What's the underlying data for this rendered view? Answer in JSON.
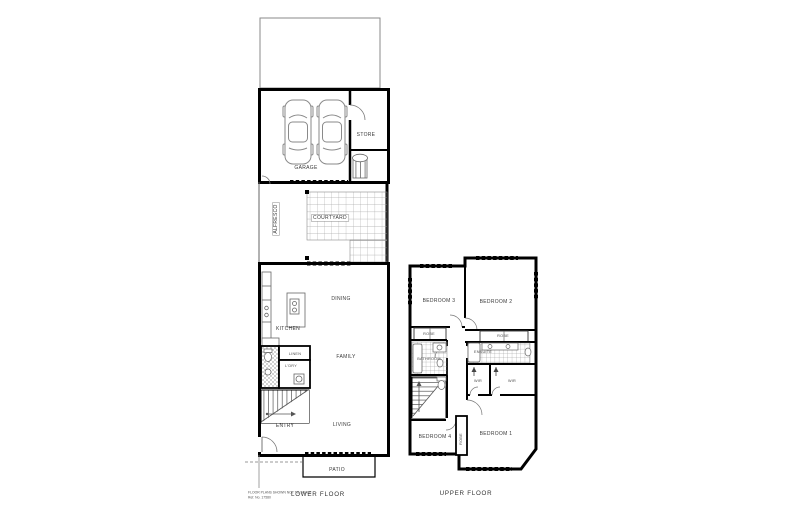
{
  "document": {
    "fine_print_line1": "FLOOR PLANS SHOWN NOT TO SCALE",
    "fine_print_line2": "Ref. No. 17580"
  },
  "lower_floor": {
    "title": "LOWER FLOOR",
    "labels": {
      "garage": "GARAGE",
      "store": "STORE",
      "alfresco": "ALFRESCO",
      "courtyard": "COURTYARD",
      "dining": "DINING",
      "kitchen": "KITCHEN",
      "linen": "LINEN",
      "laundry": "L'DRY",
      "entry": "ENTRY",
      "family": "FAMILY",
      "living": "LIVING",
      "patio": "PATIO"
    }
  },
  "upper_floor": {
    "title": "UPPER FLOOR",
    "labels": {
      "bedroom3": "BEDROOM 3",
      "bedroom2": "BEDROOM 2",
      "robe_bed3": "ROBE",
      "robe_bed2": "ROBE",
      "bathroom": "BATHROOM",
      "ensuite": "ENSUITE",
      "wir_left": "WIR",
      "wir_right": "WIR",
      "bedroom4": "BEDROOM 4",
      "robe_bed1": "ROBE",
      "bedroom1": "BEDROOM 1"
    }
  },
  "colors": {
    "wall": "#000000",
    "tile_line": "#a8a8a8",
    "fixture_line": "#777777",
    "background": "#ffffff"
  }
}
